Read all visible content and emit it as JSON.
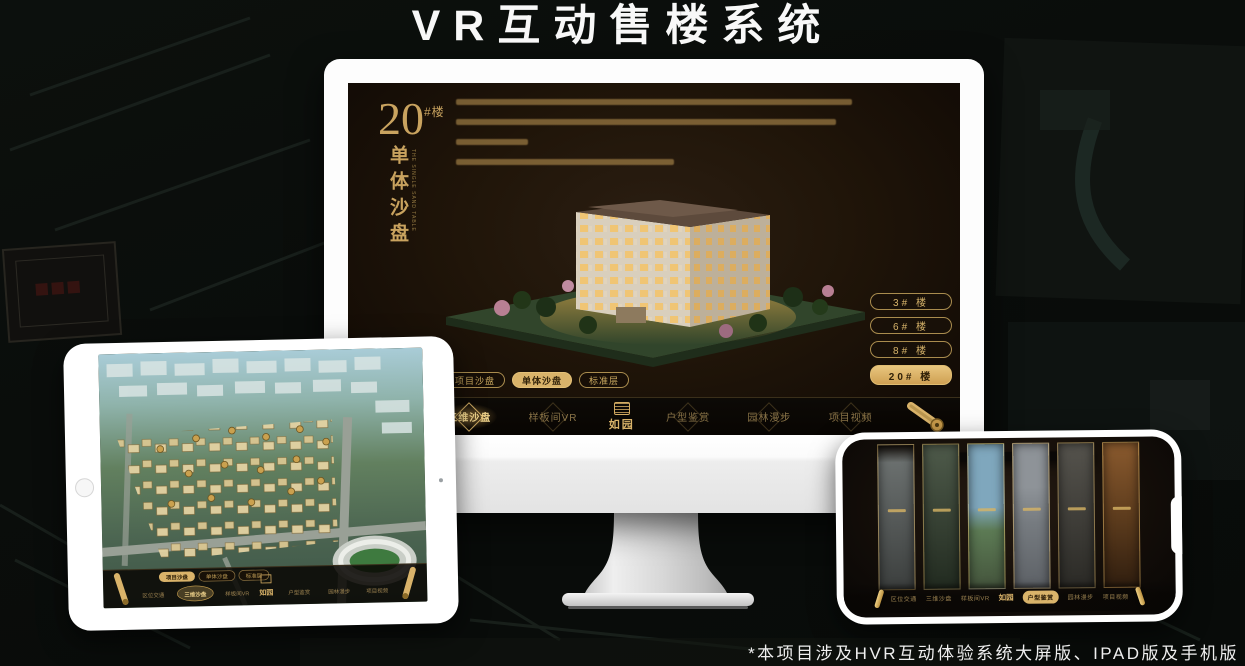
{
  "page": {
    "title": "VR互动售楼系统",
    "footnote": "*本项目涉及HVR互动体验系统大屏版、IPAD版及手机版"
  },
  "colors": {
    "gold_accent": "#d3ab62",
    "gold_highlight": "#d9b36a",
    "screen_brown": "#1b120a",
    "title_white": "#f8f8f8",
    "background": "#0a0d0b"
  },
  "icons": {
    "nav_end_left": "scroll-icon",
    "nav_end_right": "scroll-icon",
    "logo_emblem": "seal-icon",
    "nav_item_backdrop": "diamond-icon"
  },
  "monitor": {
    "block_number": "20",
    "block_unit": "#楼",
    "block_title_vertical": "单体沙盘",
    "block_title_en": "THE SINGLE SAND TABLE",
    "floor_buttons": [
      {
        "label": "3# 楼",
        "active": false
      },
      {
        "label": "6# 楼",
        "active": false
      },
      {
        "label": "8# 楼",
        "active": false
      },
      {
        "label": "20# 楼",
        "active": true
      }
    ],
    "sub_tabs": [
      {
        "label": "项目沙盘",
        "active": false
      },
      {
        "label": "单体沙盘",
        "active": true
      },
      {
        "label": "标准层",
        "active": false
      }
    ],
    "nav": {
      "logo": "如园",
      "items": [
        {
          "label": "区位交通",
          "active": false
        },
        {
          "label": "三维沙盘",
          "active": true
        },
        {
          "label": "样板间VR",
          "active": false
        },
        {
          "label": "户型鉴赏",
          "active": false
        },
        {
          "label": "园林漫步",
          "active": false
        },
        {
          "label": "项目视频",
          "active": false
        }
      ]
    }
  },
  "tablet": {
    "sub_tabs": [
      {
        "label": "项目沙盘",
        "active": true
      },
      {
        "label": "单体沙盘",
        "active": false
      },
      {
        "label": "标准层",
        "active": false
      }
    ],
    "nav": {
      "logo": "如园",
      "items": [
        {
          "label": "区位交通",
          "active": false
        },
        {
          "label": "三维沙盘",
          "active": true
        },
        {
          "label": "样板间VR",
          "active": false
        },
        {
          "label": "户型鉴赏",
          "active": false
        },
        {
          "label": "园林漫步",
          "active": false
        },
        {
          "label": "项目视频",
          "active": false
        }
      ]
    }
  },
  "phone": {
    "nav": {
      "logo": "如园",
      "items": [
        {
          "label": "区位交通",
          "active": false
        },
        {
          "label": "三维沙盘",
          "active": false
        },
        {
          "label": "样板间VR",
          "active": false
        },
        {
          "label": "户型鉴赏",
          "active": true
        },
        {
          "label": "园林漫步",
          "active": false
        },
        {
          "label": "项目视频",
          "active": false
        }
      ]
    }
  }
}
